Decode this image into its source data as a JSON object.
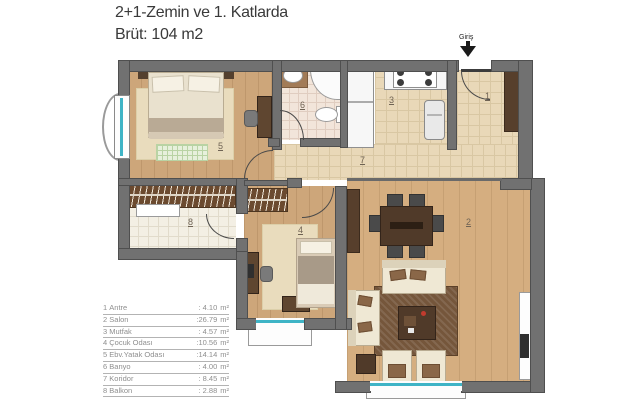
{
  "header": {
    "line1": "2+1-Zemin ve 1. Katlarda",
    "line2": "Brüt: 104 m2"
  },
  "entrance": {
    "label": "Giriş"
  },
  "rooms": [
    {
      "no": "1",
      "name": "Antre",
      "area": ": 4.10"
    },
    {
      "no": "2",
      "name": "Salon",
      "area": ":26.79"
    },
    {
      "no": "3",
      "name": "Mutfak",
      "area": ": 4.57"
    },
    {
      "no": "4",
      "name": "Çocuk Odası",
      "area": ":10.56"
    },
    {
      "no": "5",
      "name": "Ebv.Yatak Odası",
      "area": ":14.14"
    },
    {
      "no": "6",
      "name": "Banyo",
      "area": ": 4.00"
    },
    {
      "no": "7",
      "name": "Koridor",
      "area": ": 8.45"
    },
    {
      "no": "8",
      "name": "Balkon",
      "area": ": 2.88"
    }
  ],
  "units": {
    "area": "m²"
  },
  "colors": {
    "wall": "#717171",
    "wall_outline": "#4f4f4f",
    "window_glass": "#3fb4c6",
    "wood_light": "#cda67a",
    "wood_salon": "#d5ae80",
    "tile": "#e9d8b8",
    "dark_wood": "#503a29"
  }
}
